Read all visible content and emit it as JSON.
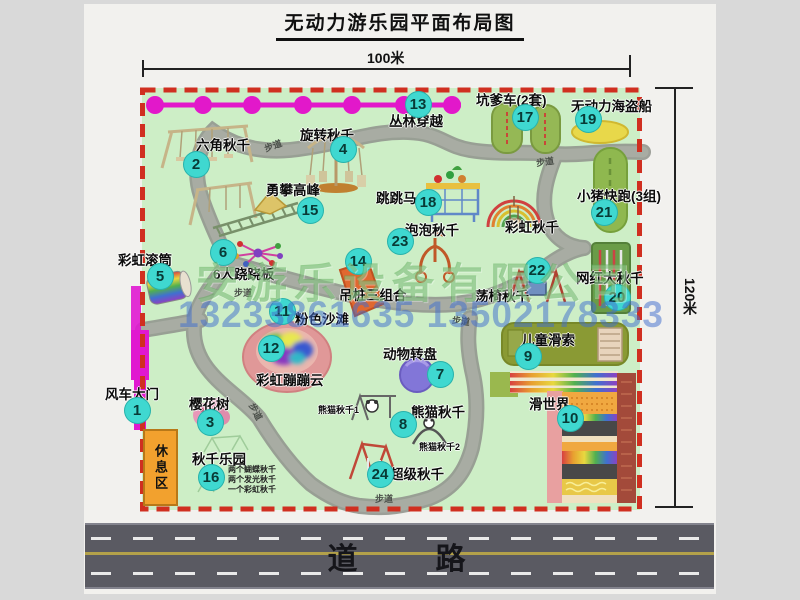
{
  "title": "无动力游乐园平面布局图",
  "dimensions": {
    "width_label": "100米",
    "height_label": "120米"
  },
  "road_label": "道　　路",
  "watermark": {
    "company": "安游乐设备有限公司",
    "phone": "13233861635 13502178333"
  },
  "rest_area_label": "休息区",
  "path_label_text": "步道",
  "colors": {
    "map_bg": "#cdeec6",
    "border_dashed": "#d02f20",
    "marker_fill": "#3fd8d0",
    "jungle_line": "#e218ca",
    "road_fill": "#5a5a62",
    "rest_area_fill": "#f2a12e",
    "path_gray": "#a5a9a1",
    "beach_pink": "#e09898"
  },
  "attractions": [
    {
      "num": 1,
      "name": "风车大门",
      "label_x": 105,
      "label_y": 383,
      "marker_x": 137,
      "marker_y": 410
    },
    {
      "num": 2,
      "name": "六角秋千",
      "label_x": 196,
      "label_y": 134,
      "marker_x": 196,
      "marker_y": 164
    },
    {
      "num": 3,
      "name": "樱花树",
      "label_x": 189,
      "label_y": 393,
      "marker_x": 210,
      "marker_y": 422
    },
    {
      "num": 4,
      "name": "旋转秋千",
      "label_x": 300,
      "label_y": 124,
      "marker_x": 343,
      "marker_y": 149
    },
    {
      "num": 5,
      "name": "彩虹滚筒",
      "label_x": 118,
      "label_y": 249,
      "marker_x": 160,
      "marker_y": 276
    },
    {
      "num": 6,
      "name": "6人跷跷板",
      "label_x": 213,
      "label_y": 263,
      "marker_x": 223,
      "marker_y": 252
    },
    {
      "num": 7,
      "name": "动物转盘",
      "label_x": 383,
      "label_y": 343,
      "marker_x": 440,
      "marker_y": 374
    },
    {
      "num": 8,
      "name": "熊猫秋千",
      "label_x": 411,
      "label_y": 401,
      "marker_x": 403,
      "marker_y": 424
    },
    {
      "num": 9,
      "name": "儿童滑索",
      "label_x": 521,
      "label_y": 329,
      "marker_x": 528,
      "marker_y": 356
    },
    {
      "num": 10,
      "name": "滑世界",
      "label_x": 529,
      "label_y": 393,
      "marker_x": 570,
      "marker_y": 418
    },
    {
      "num": 11,
      "name": "粉色沙滩",
      "label_x": 295,
      "label_y": 308,
      "marker_x": 282,
      "marker_y": 311
    },
    {
      "num": 12,
      "name": "彩虹蹦蹦云",
      "label_x": 256,
      "label_y": 369,
      "marker_x": 271,
      "marker_y": 348
    },
    {
      "num": 13,
      "name": "丛林穿越",
      "label_x": 389,
      "label_y": 110,
      "marker_x": 418,
      "marker_y": 104
    },
    {
      "num": 14,
      "name": "吊桩三组合",
      "label_x": 339,
      "label_y": 284,
      "marker_x": 358,
      "marker_y": 261
    },
    {
      "num": 15,
      "name": "勇攀高峰",
      "label_x": 266,
      "label_y": 179,
      "marker_x": 310,
      "marker_y": 210
    },
    {
      "num": 16,
      "name": "秋千乐园",
      "label_x": 192,
      "label_y": 448,
      "marker_x": 211,
      "marker_y": 477,
      "sub": [
        "两个蝴蝶秋千",
        "两个发光秋千",
        "一个彩虹秋千"
      ],
      "sub_x": 228,
      "sub_y": 465
    },
    {
      "num": 17,
      "name": "坑爹车(2套)",
      "label_x": 476,
      "label_y": 89,
      "marker_x": 525,
      "marker_y": 117
    },
    {
      "num": 18,
      "name": "跳跳马",
      "label_x": 376,
      "label_y": 187,
      "marker_x": 428,
      "marker_y": 202
    },
    {
      "num": 19,
      "name": "无动力海盗船",
      "label_x": 571,
      "label_y": 95,
      "marker_x": 588,
      "marker_y": 119
    },
    {
      "num": 20,
      "name": "网红大秋千",
      "label_x": 576,
      "label_y": 267,
      "marker_x": 617,
      "marker_y": 297
    },
    {
      "num": 21,
      "name": "小猪快跑(3组)",
      "label_x": 577,
      "label_y": 185,
      "marker_x": 604,
      "marker_y": 212
    },
    {
      "num": 22,
      "name": "荡椅秋千",
      "label_x": 475,
      "label_y": 285,
      "marker_x": 537,
      "marker_y": 270
    },
    {
      "num": 23,
      "name": "泡泡秋千",
      "label_x": 405,
      "label_y": 219,
      "marker_x": 400,
      "marker_y": 241
    },
    {
      "num": 24,
      "name": "超级秋千",
      "label_x": 390,
      "label_y": 463,
      "marker_x": 380,
      "marker_y": 474
    }
  ],
  "extra_labels": [
    {
      "text": "彩虹秋千",
      "x": 505,
      "y": 216,
      "tiny": false
    },
    {
      "text": "熊猫秋千1",
      "x": 318,
      "y": 403,
      "tiny": true
    },
    {
      "text": "熊猫秋千2",
      "x": 419,
      "y": 440,
      "tiny": true
    }
  ],
  "path_label_positions": [
    {
      "x": 264,
      "y": 139,
      "rot": -20
    },
    {
      "x": 536,
      "y": 155,
      "rot": -8
    },
    {
      "x": 234,
      "y": 286,
      "rot": 0
    },
    {
      "x": 247,
      "y": 405,
      "rot": 62
    },
    {
      "x": 375,
      "y": 492,
      "rot": 0
    },
    {
      "x": 452,
      "y": 314,
      "rot": 8
    }
  ]
}
